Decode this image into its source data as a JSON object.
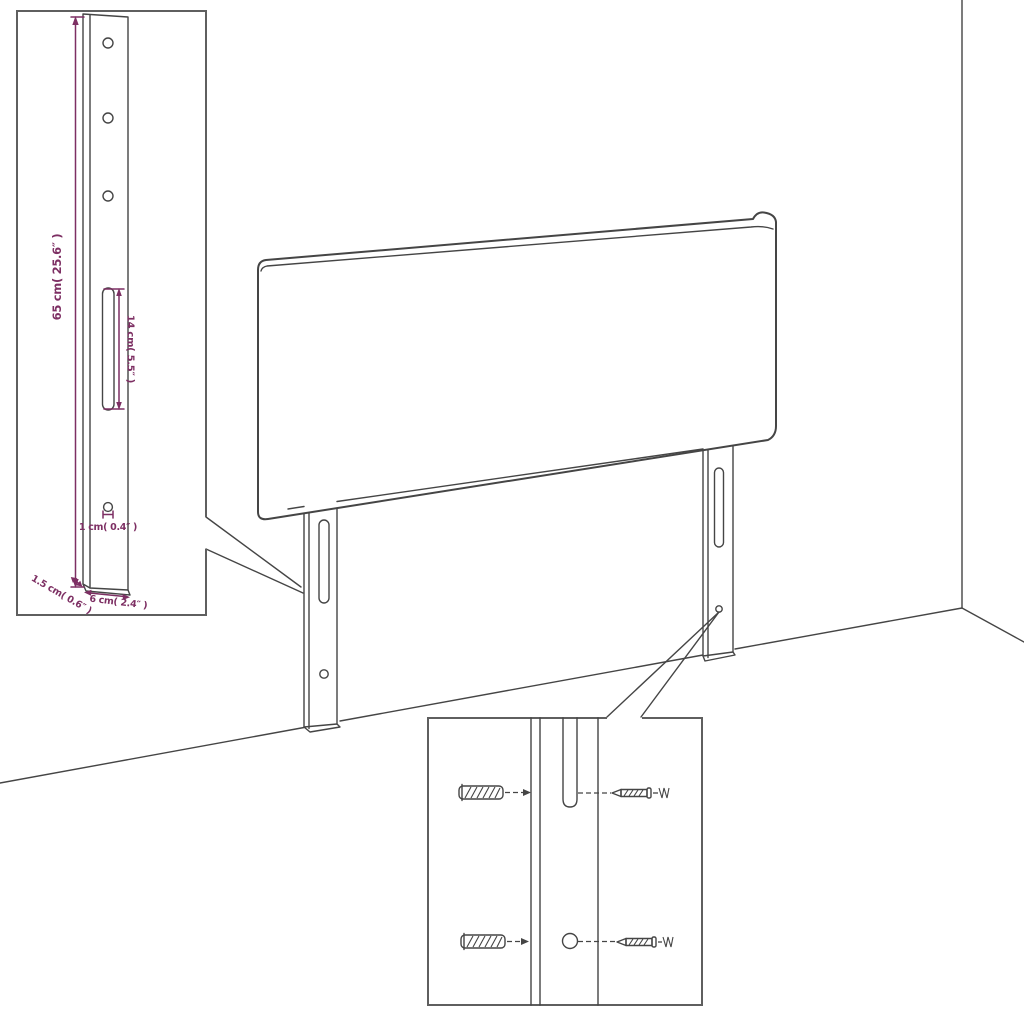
{
  "page": {
    "background": "#ffffff"
  },
  "colors": {
    "line_work": "#454545",
    "inset_border": "#5f5f5f",
    "dimension_accent": "#7d2f63"
  },
  "bracket_detail_inset": {
    "dimensions": {
      "bracket_height": "65 cm( 25.6″ )",
      "slot_length": "14 cm( 5.5″ )",
      "hole_diameter": "1 cm( 0.4″ )",
      "bracket_thickness": "1.5 cm( 0.6″ )",
      "bracket_width": "6 cm( 2.4″ )"
    }
  }
}
